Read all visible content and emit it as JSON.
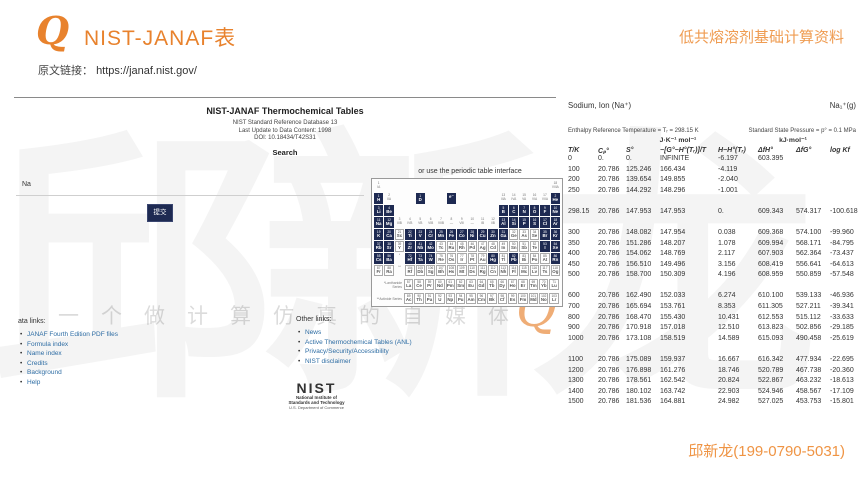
{
  "header": {
    "logo_glyph": "Q",
    "title": "NIST-JANAF表",
    "subtitle": "低共熔溶剂基础计算资料",
    "source_label": "原文链接：",
    "source_url": "https://janaf.nist.gov/",
    "footer_contact": "邱新龙(199-0790-5031)"
  },
  "watermark": {
    "big_text": "邱新龙",
    "slogan": "一个做计算仿真的自媒体",
    "logo_glyph": "Q"
  },
  "site": {
    "title": "NIST-JANAF Thermochemical Tables",
    "subtitle_lines": [
      "NIST Standard Reference Database 13",
      "Last Update to Data Content: 1998",
      "DOI: 10.18434/T42S31"
    ],
    "search_heading": "Search",
    "search_value": "Na",
    "submit_label": "提交",
    "pt_hint": "or use the periodic table interface",
    "data_links_heading": "ata links:",
    "data_links": [
      "JANAF Fourth Edition PDF files",
      "Formula index",
      "Name index",
      "Credits",
      "Background",
      "Help"
    ],
    "other_links_heading": "Other links:",
    "other_links": [
      "News",
      "Active Thermochemical Tables (ANL)",
      "Privacy/Security/Accessibility",
      "NIST disclaimer"
    ],
    "nist_logo": {
      "wordmark": "NIST",
      "line1": "National Institute of",
      "line2": "Standards and Technology",
      "line3": "U.S. Department of Commerce"
    },
    "periodic_table": {
      "lanthanide_label": "*Lanthanide Series",
      "actinide_label": "**Actinide Series",
      "rows": [
        [
          "L:1|IA",
          "",
          "",
          "",
          "",
          "",
          "",
          "",
          "",
          "",
          "",
          "",
          "",
          "",
          "",
          "",
          "",
          "L:18|VIIIA"
        ],
        [
          "1 H*",
          "L:2|IIA",
          "",
          "",
          "1 D*",
          "",
          "",
          " e⁻*",
          "",
          "",
          "",
          "",
          "L:13|IIIA",
          "L:14|IVA",
          "L:15|VA",
          "L:16|VIA",
          "L:17|VIIA",
          "2 He*"
        ],
        [
          "3 Li*",
          "4 Be*",
          "",
          "",
          "",
          "",
          "",
          "",
          "",
          "",
          "",
          "",
          "5 B*",
          "6 C*",
          "7 N*",
          "8 O*",
          "9 F*",
          "10 Ne*"
        ],
        [
          "11 Na*",
          "12 Mg*",
          "L:3|IIIB",
          "L:4|IVB",
          "L:5|VB",
          "L:6|VIB",
          "L:7|VIIB",
          "L:8|—",
          "L:9|VIII",
          "L:10|—",
          "L:11|IB",
          "L:12|IIB",
          "13 Al*",
          "14 Si*",
          "15 P*",
          "16 S*",
          "17 Cl*",
          "18 Ar*"
        ],
        [
          "19 K*",
          "20 Ca*",
          "21 Sc",
          "22 Ti*",
          "23 V*",
          "24 Cr*",
          "25 Mn*",
          "26 Fe*",
          "27 Co*",
          "28 Ni*",
          "29 Cu*",
          "30 Zn*",
          "31 Ga*",
          "32 Ge",
          "33 As",
          "34 Se",
          "35 Br*",
          "36 Kr*"
        ],
        [
          "37 Rb*",
          "38 Sr*",
          "39 Y",
          "40 Zr*",
          "41 Nb*",
          "42 Mo*",
          "43 Tc",
          "44 Ru",
          "45 Rh",
          "46 Pd",
          "47 Ag",
          "48 Cd",
          "49 In",
          "50 Sn",
          "51 Sb",
          "52 Te",
          "53 I*",
          "54 Xe*"
        ],
        [
          "55 Cs*",
          "56 Ba*",
          "L:*",
          "72 Hf*",
          "73 Ta*",
          "74 W*",
          "75 Re",
          "76 Os",
          "77 Ir",
          "78 Pt",
          "79 Au",
          "80 Hg*",
          "81 Tl",
          "82 Pb*",
          "83 Bi",
          "84 Po",
          "85 At",
          "86 Rn*"
        ],
        [
          "87 Fr",
          "88 Ra",
          "L:**",
          "104 Rf",
          "105 Db",
          "106 Sg",
          "107 Bh",
          "108 Hs",
          "109 Mt",
          "110 Ds",
          "111 Rg",
          "112 Cn",
          "113 Nh",
          "114 Fl",
          "115 Mc",
          "116 Lv",
          "117 Ts",
          "118 Og"
        ]
      ],
      "lanthanides": [
        "57 La",
        "58 Ce",
        "59 Pr",
        "60 Nd",
        "61 Pm",
        "62 Sm",
        "63 Eu",
        "64 Gd",
        "65 Tb",
        "66 Dy",
        "67 Ho",
        "68 Er",
        "69 Tm",
        "70 Yb",
        "71 Lu"
      ],
      "actinides": [
        "89 Ac",
        "90 Th",
        "91 Pa",
        "92 U",
        "93 Np",
        "94 Pu",
        "95 Am",
        "96 Cm",
        "97 Bk",
        "98 Cf",
        "99 Es",
        "100 Fm",
        "101 Md",
        "102 No",
        "103 Lr"
      ]
    }
  },
  "janaf": {
    "species_name": "Sodium, Ion (Na⁺)",
    "species_formula": "Na₁⁺(g)",
    "enthalpy_note": "Enthalpy Reference Temperature = Tᵣ = 298.15 K",
    "pressure_note": "Standard State Pressure = p° = 0.1 MPa",
    "units_left": "J·K⁻¹ mol⁻¹",
    "units_right": "kJ·mol⁻¹",
    "columns": [
      "T/K",
      "Cₚ°",
      "S°",
      "−[G°−H°(Tᵣ)]/T",
      "H−H°(Tᵣ)",
      "ΔfH°",
      "ΔfG°",
      "log Kf"
    ],
    "row_groups": [
      [
        [
          "0",
          "0.",
          "0.",
          "INFINITE",
          "-6.197",
          "603.395",
          "",
          ""
        ],
        [
          "100",
          "20.786",
          "125.246",
          "166.434",
          "-4.119",
          "",
          "",
          ""
        ],
        [
          "200",
          "20.786",
          "139.654",
          "149.855",
          "-2.040",
          "",
          "",
          ""
        ],
        [
          "250",
          "20.786",
          "144.292",
          "148.296",
          "-1.001",
          "",
          "",
          ""
        ]
      ],
      [
        [
          "298.15",
          "20.786",
          "147.953",
          "147.953",
          "0.",
          "609.343",
          "574.317",
          "-100.618"
        ]
      ],
      [
        [
          "300",
          "20.786",
          "148.082",
          "147.954",
          "0.038",
          "609.368",
          "574.100",
          "-99.960"
        ],
        [
          "350",
          "20.786",
          "151.286",
          "148.207",
          "1.078",
          "609.994",
          "568.171",
          "-84.795"
        ],
        [
          "400",
          "20.786",
          "154.062",
          "148.769",
          "2.117",
          "607.903",
          "562.364",
          "-73.437"
        ],
        [
          "450",
          "20.786",
          "156.510",
          "149.496",
          "3.156",
          "608.419",
          "556.641",
          "-64.613"
        ],
        [
          "500",
          "20.786",
          "158.700",
          "150.309",
          "4.196",
          "608.959",
          "550.859",
          "-57.548"
        ]
      ],
      [
        [
          "600",
          "20.786",
          "162.490",
          "152.033",
          "6.274",
          "610.100",
          "539.133",
          "-46.936"
        ],
        [
          "700",
          "20.786",
          "165.694",
          "153.761",
          "8.353",
          "611.305",
          "527.211",
          "-39.341"
        ],
        [
          "800",
          "20.786",
          "168.470",
          "155.430",
          "10.431",
          "612.553",
          "515.112",
          "-33.633"
        ],
        [
          "900",
          "20.786",
          "170.918",
          "157.018",
          "12.510",
          "613.823",
          "502.856",
          "-29.185"
        ],
        [
          "1000",
          "20.786",
          "173.108",
          "158.519",
          "14.589",
          "615.093",
          "490.458",
          "-25.619"
        ]
      ],
      [
        [
          "1100",
          "20.786",
          "175.089",
          "159.937",
          "16.667",
          "616.342",
          "477.934",
          "-22.695"
        ],
        [
          "1200",
          "20.786",
          "176.898",
          "161.276",
          "18.746",
          "520.789",
          "467.738",
          "-20.360"
        ],
        [
          "1300",
          "20.786",
          "178.561",
          "162.542",
          "20.824",
          "522.867",
          "463.232",
          "-18.613"
        ],
        [
          "1400",
          "20.786",
          "180.102",
          "163.742",
          "22.903",
          "524.946",
          "458.567",
          "-17.109"
        ],
        [
          "1500",
          "20.786",
          "181.536",
          "164.881",
          "24.982",
          "527.025",
          "453.753",
          "-15.801"
        ]
      ]
    ]
  }
}
